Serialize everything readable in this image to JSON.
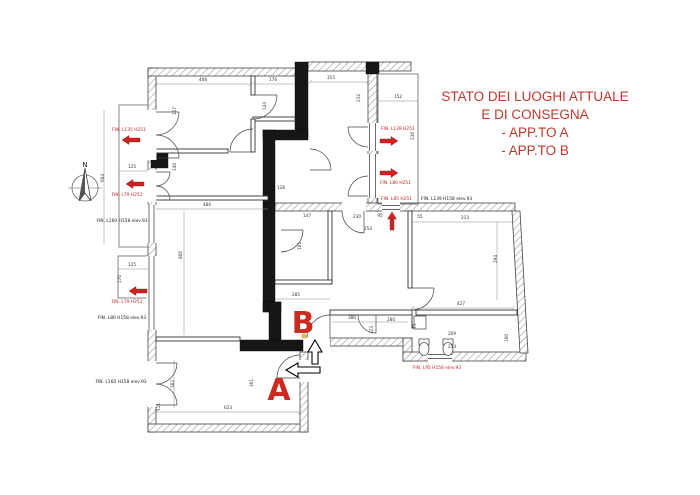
{
  "title": {
    "lines": [
      "STATO DEI LUOGHI ATTUALE",
      "E DI CONSEGNA",
      "- APP.TO A",
      "- APP.TO B"
    ],
    "color": "#c0392b"
  },
  "apartment_labels": {
    "a": "A",
    "b": "B"
  },
  "compass": {
    "north": "N"
  },
  "colors": {
    "annotation_red": "#cc2222",
    "drawing_line": "#444444"
  },
  "entrance_arrows": [
    {
      "apartment": "B",
      "direction": "up"
    },
    {
      "apartment": "A",
      "direction": "left"
    }
  ],
  "window_labels": [
    {
      "text": "FIN. L135 H251",
      "x": 129,
      "y": 131,
      "color": "red",
      "anchor": "middle"
    },
    {
      "text": "FIN. L79 H251",
      "x": 127,
      "y": 196,
      "color": "red",
      "anchor": "middle"
    },
    {
      "text": "FIN. L79 H251",
      "x": 127,
      "y": 303,
      "color": "red",
      "anchor": "middle"
    },
    {
      "text": "FIN. L160 H158 elev.93",
      "x": 122,
      "y": 222,
      "color": "black",
      "anchor": "middle"
    },
    {
      "text": "FIN. L80 H158 elev.93",
      "x": 122,
      "y": 319,
      "color": "black",
      "anchor": "middle"
    },
    {
      "text": "FIN. L160 H158 elev.93",
      "x": 121,
      "y": 383,
      "color": "black",
      "anchor": "middle"
    },
    {
      "text": "FIN. L139 H251",
      "x": 381,
      "y": 130,
      "color": "red",
      "anchor": "start"
    },
    {
      "text": "FIN. L80 H251",
      "x": 380,
      "y": 184,
      "color": "red",
      "anchor": "start"
    },
    {
      "text": "FIN. L85 H251",
      "x": 381,
      "y": 200,
      "color": "red",
      "anchor": "start"
    },
    {
      "text": "FIN. L139 H158 elev.93",
      "x": 421,
      "y": 200,
      "color": "black",
      "anchor": "start"
    },
    {
      "text": "FIN. L95 H158 elev.93",
      "x": 437,
      "y": 369,
      "color": "red",
      "anchor": "middle"
    }
  ],
  "window_arrows": [
    {
      "x": 131,
      "y": 140,
      "dir": "left"
    },
    {
      "x": 135,
      "y": 184,
      "dir": "left"
    },
    {
      "x": 138,
      "y": 291,
      "dir": "left"
    },
    {
      "x": 389,
      "y": 141,
      "dir": "right"
    },
    {
      "x": 389,
      "y": 173,
      "dir": "right"
    },
    {
      "x": 392,
      "y": 221,
      "dir": "up"
    }
  ],
  "dimensions": [
    {
      "t": "408",
      "x": 203,
      "y": 81
    },
    {
      "t": "176",
      "x": 273,
      "y": 81
    },
    {
      "t": "315",
      "x": 331,
      "y": 79
    },
    {
      "t": "152",
      "x": 398,
      "y": 98
    },
    {
      "t": "157",
      "x": 176,
      "y": 111,
      "v": true
    },
    {
      "t": "144",
      "x": 266,
      "y": 106,
      "v": true
    },
    {
      "t": "232",
      "x": 360,
      "y": 98,
      "v": true
    },
    {
      "t": "236",
      "x": 414,
      "y": 136,
      "v": true
    },
    {
      "t": "128",
      "x": 281,
      "y": 189
    },
    {
      "t": "125",
      "x": 132,
      "y": 168
    },
    {
      "t": "604",
      "x": 104,
      "y": 178,
      "v": true
    },
    {
      "t": "486",
      "x": 207,
      "y": 206
    },
    {
      "t": "140",
      "x": 176,
      "y": 167,
      "v": true
    },
    {
      "t": "806",
      "x": 182,
      "y": 255,
      "v": true
    },
    {
      "t": "125",
      "x": 132,
      "y": 266
    },
    {
      "t": "170",
      "x": 121,
      "y": 279,
      "v": true
    },
    {
      "t": "147",
      "x": 307,
      "y": 217
    },
    {
      "t": "101",
      "x": 301,
      "y": 246,
      "v": true
    },
    {
      "t": "230",
      "x": 357,
      "y": 218
    },
    {
      "t": "254",
      "x": 368,
      "y": 230
    },
    {
      "t": "95",
      "x": 380,
      "y": 217
    },
    {
      "t": "55",
      "x": 420,
      "y": 218
    },
    {
      "t": "213",
      "x": 465,
      "y": 219
    },
    {
      "t": "294",
      "x": 497,
      "y": 259,
      "v": true
    },
    {
      "t": "285",
      "x": 296,
      "y": 296
    },
    {
      "t": "427",
      "x": 461,
      "y": 305
    },
    {
      "t": "380",
      "x": 352,
      "y": 319
    },
    {
      "t": "280",
      "x": 391,
      "y": 321
    },
    {
      "t": "323",
      "x": 373,
      "y": 330,
      "v": true
    },
    {
      "t": "209",
      "x": 452,
      "y": 335
    },
    {
      "t": "214",
      "x": 452,
      "y": 348
    },
    {
      "t": "160",
      "x": 508,
      "y": 338,
      "v": true
    },
    {
      "t": "75",
      "x": 416,
      "y": 326,
      "v": true
    },
    {
      "t": "623",
      "x": 228,
      "y": 409
    },
    {
      "t": "382",
      "x": 174,
      "y": 384,
      "v": true
    },
    {
      "t": "361",
      "x": 253,
      "y": 383,
      "v": true
    },
    {
      "t": "111",
      "x": 160,
      "y": 407,
      "v": true
    }
  ]
}
